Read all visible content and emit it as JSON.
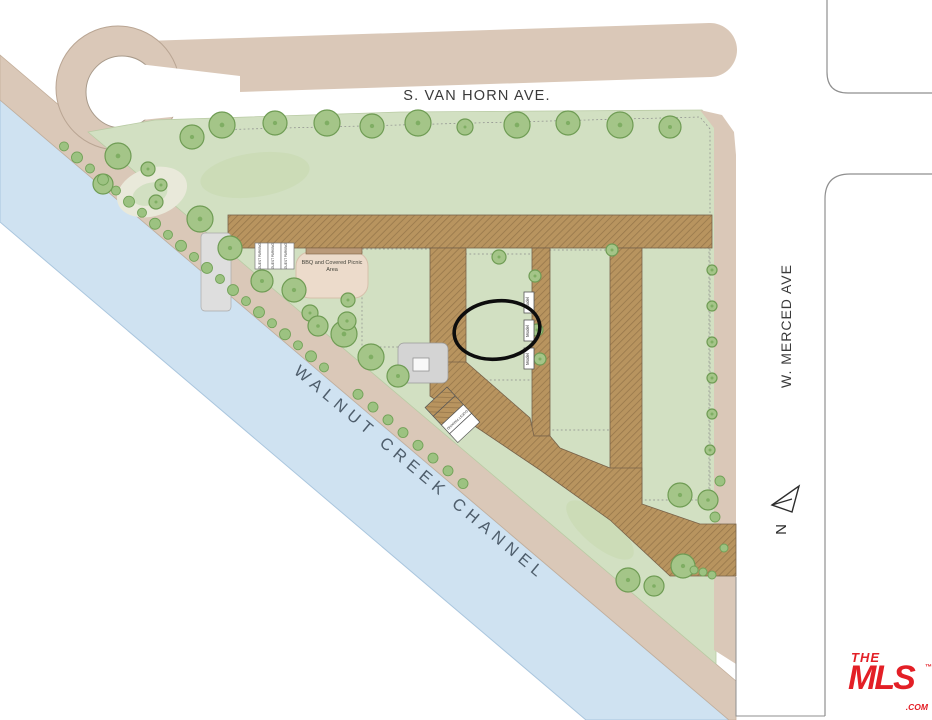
{
  "streets": {
    "top": "S. VAN HORN AVE.",
    "right": "W. MERCED AVE",
    "channel": "WALNUT CREEK CHANNEL",
    "north_label": "N"
  },
  "amenities": {
    "bbq": "BBQ and Covered Picnic Area",
    "guest_parking": "GUEST PARKING",
    "model": "Model"
  },
  "highlight": {
    "unit": "34"
  },
  "buildings": [
    {
      "name": "van-horn-row-west",
      "units": [
        {
          "num": "17",
          "plan": "3DR"
        },
        {
          "num": "16",
          "plan": "1A"
        },
        {
          "num": "15",
          "plan": "2A"
        },
        {
          "num": "14",
          "plan": "1B"
        },
        {
          "num": "13",
          "plan": "2B"
        },
        {
          "num": "12",
          "plan": "1BR"
        },
        {
          "num": "11",
          "plan": "2AR"
        },
        {
          "num": "10",
          "plan": "1AR"
        },
        {
          "num": "9",
          "plan": "3B"
        }
      ]
    },
    {
      "name": "van-horn-row-east",
      "units": [
        {
          "num": "8",
          "plan": "3BR"
        },
        {
          "num": "7",
          "plan": "1A"
        },
        {
          "num": "6",
          "plan": "2A"
        },
        {
          "num": "5",
          "plan": "1B"
        },
        {
          "num": "4",
          "plan": "2B"
        },
        {
          "num": "3",
          "plan": "1BR"
        },
        {
          "num": "2",
          "plan": "2CR"
        },
        {
          "num": "1",
          "plan": "3A"
        }
      ]
    },
    {
      "name": "west-court",
      "units": [
        {
          "num": "39",
          "plan": "3D"
        },
        {
          "num": "38",
          "plan": "2C"
        },
        {
          "num": "37",
          "plan": "3CR",
          "ada": "ADA"
        }
      ]
    },
    {
      "name": "model-court",
      "units": [
        {
          "num": "36",
          "plan": "3DR",
          "ada": "ADA"
        },
        {
          "num": "35",
          "plan": "1A",
          "model": true
        },
        {
          "num": "34",
          "plan": "2A",
          "model": true,
          "highlighted": true
        },
        {
          "num": "33",
          "plan": "3A",
          "ada": "ADA",
          "model": true
        }
      ]
    },
    {
      "name": "central-court",
      "units": [
        {
          "num": "32",
          "plan": "3D"
        },
        {
          "num": "31",
          "plan": "1AR"
        },
        {
          "num": "30",
          "plan": "2AR"
        },
        {
          "num": "29",
          "plan": "1BR"
        },
        {
          "num": "28",
          "plan": "2D"
        },
        {
          "num": "27",
          "plan": "3ER",
          "ada": "ADA"
        }
      ]
    },
    {
      "name": "merced-row",
      "units": [
        {
          "num": "26",
          "plan": "3DR"
        },
        {
          "num": "25",
          "plan": "1A"
        },
        {
          "num": "24",
          "plan": "2A"
        },
        {
          "num": "23",
          "plan": "1B"
        },
        {
          "num": "22",
          "plan": "2B"
        },
        {
          "num": "21",
          "plan": "1BR"
        },
        {
          "num": "20",
          "plan": "2AR"
        },
        {
          "num": "19",
          "plan": "1AR"
        },
        {
          "num": "18",
          "plan": "3C"
        }
      ]
    }
  ],
  "logo": {
    "line1": "THE",
    "line2": "MLS",
    "suffix": ".COM",
    "tm": "™"
  },
  "colors": {
    "water": "#cfe2f1",
    "shore": "#dac8b8",
    "green": "#d2e0c2",
    "tree": "#a4c588",
    "drive": "#b8945f",
    "highlight": "#111111",
    "logo_red": "#e31f26"
  }
}
